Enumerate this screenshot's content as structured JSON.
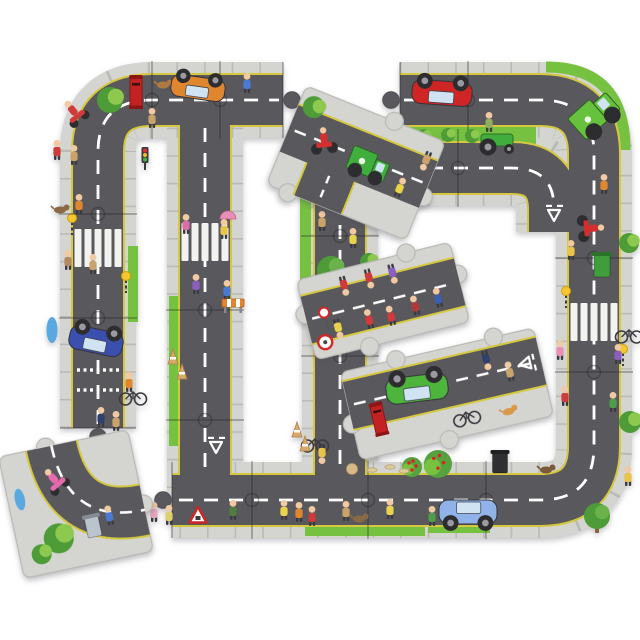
{
  "subject": "giant road jigsaw puzzle partially assembled on white background",
  "palette": {
    "background": "#ffffff",
    "sidewalk": "#d4d4d1",
    "sidewalkTick": "#b2b2ae",
    "pieceEdge": "#b9b9b5",
    "tarmac": "#59595d",
    "yellowLine": "#d5c83e",
    "centerLine": "#ffffff",
    "grass": "#76c13f",
    "bushDark": "#4d9c38",
    "bushLight": "#8cc94e",
    "skin": "#f1c9a2",
    "wheel": "#2d2d30",
    "joint": "rgba(35,35,40,0.38)"
  },
  "road_widths": {
    "sidewalk": 76,
    "yellow": 54,
    "tarmac": 50,
    "center": 2.8,
    "dash": "14 11",
    "tick": "1.6 26"
  },
  "assembled": {
    "roads": [
      {
        "name": "left-and-top-road",
        "d": "M 98 428 L 98 152 Q 98 100 152 100 L 283 100"
      },
      {
        "name": "topright-right-bottom-road",
        "d": "M 400 100 L 540 100 Q 594 100 594 154 L 594 446 Q 594 500 540 500 L 172 500"
      },
      {
        "name": "inner-road-a",
        "d": "M 205 100 L 205 492"
      },
      {
        "name": "inner-road-b",
        "d": "M 340 124 L 340 492"
      },
      {
        "name": "branch-road",
        "d": "M 400 168 L 512 168 Q 554 168 554 210 L 554 232"
      }
    ],
    "dashes": [
      "M 98 424 L 98 152 Q 98 100 152 100 L 279 100",
      "M 404 100 L 540 100 Q 594 100 594 154 L 594 446 Q 594 500 540 500 L 176 500",
      "M 205 128 L 205 470",
      "M 340 150 L 340 470",
      "M 404 168 L 512 168 Q 554 168 554 208"
    ],
    "grass_rects": [
      {
        "x": 402,
        "y": 126,
        "w": 134,
        "h": 19
      },
      {
        "x": 300,
        "y": 150,
        "w": 11,
        "h": 145
      },
      {
        "x": 169,
        "y": 296,
        "w": 11,
        "h": 150
      },
      {
        "x": 128,
        "y": 246,
        "w": 10,
        "h": 76
      },
      {
        "x": 305,
        "y": 527,
        "w": 120,
        "h": 9
      },
      {
        "x": 428,
        "y": 524,
        "w": 62,
        "h": 9
      }
    ],
    "grass_arcs": [
      {
        "d": "M 546 67 Q 625 67 625 150",
        "w": 11
      }
    ],
    "zebras": [
      {
        "x": 98,
        "y": 248
      },
      {
        "x": 205,
        "y": 242
      },
      {
        "x": 594,
        "y": 322
      }
    ],
    "beacons": [
      {
        "x": 72,
        "y": 220
      },
      {
        "x": 126,
        "y": 278
      },
      {
        "x": 566,
        "y": 293
      },
      {
        "x": 623,
        "y": 351
      }
    ],
    "dotted": [
      {
        "x": 98,
        "y": 370
      },
      {
        "x": 98,
        "y": 390
      }
    ],
    "giveways": [
      {
        "x": 340,
        "y": 176,
        "a": 0
      },
      {
        "x": 216,
        "y": 446,
        "a": 180
      },
      {
        "x": 554,
        "y": 214,
        "a": 180
      }
    ],
    "joints": [
      {
        "x": 152,
        "y": 100,
        "o": "v"
      },
      {
        "x": 220,
        "y": 100,
        "o": "v"
      },
      {
        "x": 468,
        "y": 100,
        "o": "v"
      },
      {
        "x": 98,
        "y": 214,
        "o": "h"
      },
      {
        "x": 98,
        "y": 318,
        "o": "h"
      },
      {
        "x": 594,
        "y": 258,
        "o": "h"
      },
      {
        "x": 594,
        "y": 372,
        "o": "h"
      },
      {
        "x": 252,
        "y": 500,
        "o": "v"
      },
      {
        "x": 368,
        "y": 500,
        "o": "v"
      },
      {
        "x": 486,
        "y": 500,
        "o": "v"
      },
      {
        "x": 205,
        "y": 310,
        "o": "h"
      },
      {
        "x": 205,
        "y": 420,
        "o": "h"
      },
      {
        "x": 340,
        "y": 236,
        "o": "h"
      },
      {
        "x": 340,
        "y": 356,
        "o": "h"
      },
      {
        "x": 458,
        "y": 168,
        "o": "v"
      }
    ],
    "tabs": [
      {
        "x": 283,
        "y": 100,
        "o": "v",
        "k": 1
      },
      {
        "x": 400,
        "y": 100,
        "o": "v",
        "k": -1
      },
      {
        "x": 400,
        "y": 168,
        "o": "v",
        "k": -1
      },
      {
        "x": 340,
        "y": 124,
        "o": "h",
        "k": -1
      },
      {
        "x": 98,
        "y": 428,
        "o": "h",
        "k": 1
      },
      {
        "x": 172,
        "y": 500,
        "o": "v",
        "k": -1
      }
    ],
    "decor": [
      {
        "t": "scooter",
        "n": "red-quad-rider",
        "x": 74,
        "y": 112,
        "r": -38,
        "c": "#cf3a3a"
      },
      {
        "t": "bush",
        "n": "bush",
        "x": 110,
        "y": 100,
        "s": 13
      },
      {
        "t": "postbox",
        "n": "red-postbox",
        "x": 136,
        "y": 93
      },
      {
        "t": "dog",
        "n": "brown-dog",
        "x": 163,
        "y": 85,
        "c": "#b07a3f"
      },
      {
        "t": "car",
        "n": "orange-car-overturned",
        "x": 198,
        "y": 88,
        "w": 54,
        "h": 22,
        "r": 188,
        "c": "#e0862f"
      },
      {
        "t": "person",
        "n": "pedestrian",
        "x": 247,
        "y": 85,
        "c": "#4a7bd4"
      },
      {
        "t": "person",
        "n": "pedestrian",
        "x": 152,
        "y": 120,
        "c": "#caa36b"
      },
      {
        "t": "person",
        "n": "child",
        "x": 57,
        "y": 152,
        "c": "#cf3a3a"
      },
      {
        "t": "person",
        "n": "child",
        "x": 74,
        "y": 157,
        "c": "#caa36b"
      },
      {
        "t": "trafficlight",
        "n": "traffic-light",
        "x": 145,
        "y": 157
      },
      {
        "t": "dog",
        "n": "dog",
        "x": 60,
        "y": 210,
        "c": "#8a6a45"
      },
      {
        "t": "person",
        "n": "pedestrian",
        "x": 79,
        "y": 206,
        "c": "#e0862f"
      },
      {
        "t": "person",
        "n": "pedestrian",
        "x": 68,
        "y": 262,
        "c": "#b58860"
      },
      {
        "t": "person",
        "n": "pedestrian",
        "x": 93,
        "y": 266,
        "c": "#caa36b"
      },
      {
        "t": "blob",
        "n": "blue-bollard",
        "x": 52,
        "y": 330,
        "w": 11,
        "h": 26,
        "c": "#5aa8e0"
      },
      {
        "t": "car",
        "n": "blue-car-tilted",
        "x": 96,
        "y": 341,
        "w": 54,
        "h": 24,
        "r": 192,
        "c": "#3a4fae"
      },
      {
        "t": "person",
        "n": "cyclist",
        "x": 129,
        "y": 384,
        "c": "#e0862f"
      },
      {
        "t": "bicycle",
        "n": "bicycle",
        "x": 133,
        "y": 396
      },
      {
        "t": "person",
        "n": "pedestrian",
        "x": 101,
        "y": 419,
        "c": "#2f3f6e"
      },
      {
        "t": "person",
        "n": "pedestrian",
        "x": 116,
        "y": 423,
        "c": "#caa36b"
      },
      {
        "t": "person",
        "n": "mother-with-pram",
        "x": 186,
        "y": 226,
        "c": "#d86fa8"
      },
      {
        "t": "umbrella",
        "n": "pink-umbrella",
        "x": 228,
        "y": 219,
        "c": "#e88fb8"
      },
      {
        "t": "person",
        "n": "pedestrian",
        "x": 224,
        "y": 231,
        "c": "#e8c44a"
      },
      {
        "t": "person",
        "n": "pedestrian",
        "x": 196,
        "y": 286,
        "c": "#8a5fc0"
      },
      {
        "t": "person",
        "n": "pedestrian",
        "x": 227,
        "y": 292,
        "c": "#4a7bd4"
      },
      {
        "t": "barrier",
        "n": "roadworks-barrier",
        "x": 233,
        "y": 303
      },
      {
        "t": "cone",
        "n": "cone",
        "x": 173,
        "y": 357
      },
      {
        "t": "cone",
        "n": "cone",
        "x": 182,
        "y": 372
      },
      {
        "t": "person",
        "n": "pedestrian",
        "x": 322,
        "y": 223,
        "c": "#caa36b"
      },
      {
        "t": "person",
        "n": "workman",
        "x": 353,
        "y": 240,
        "c": "#e8d44a"
      },
      {
        "t": "tree",
        "n": "tree",
        "x": 331,
        "y": 270,
        "s": 14
      },
      {
        "t": "bush",
        "n": "bush",
        "x": 369,
        "y": 262,
        "s": 9
      },
      {
        "t": "bush",
        "n": "bush",
        "x": 366,
        "y": 416,
        "s": 11
      },
      {
        "t": "bicycle",
        "n": "fallen-bicycle",
        "x": 315,
        "y": 443
      },
      {
        "t": "person",
        "n": "cyclist-upside-down",
        "x": 322,
        "y": 452,
        "r": 180,
        "c": "#e8c44a"
      },
      {
        "t": "cone",
        "n": "cone",
        "x": 297,
        "y": 430
      },
      {
        "t": "cone",
        "n": "cone",
        "x": 305,
        "y": 444
      },
      {
        "t": "bush",
        "n": "median-tree",
        "x": 424,
        "y": 136,
        "s": 7
      },
      {
        "t": "bush",
        "n": "median-tree",
        "x": 448,
        "y": 135,
        "s": 7
      },
      {
        "t": "bush",
        "n": "median-tree",
        "x": 472,
        "y": 136,
        "s": 7
      },
      {
        "t": "car",
        "n": "red-car-overturned",
        "x": 442,
        "y": 93,
        "w": 60,
        "h": 24,
        "r": 184,
        "c": "#cf2525"
      },
      {
        "t": "tractor",
        "n": "lawn-tractor",
        "x": 497,
        "y": 139,
        "c": "#3fae3d"
      },
      {
        "t": "person",
        "n": "tractor-driver",
        "x": 489,
        "y": 124,
        "c": "#8fae5f"
      },
      {
        "t": "truck",
        "n": "recycling-truck",
        "x": 594,
        "y": 114,
        "w": 46,
        "h": 28,
        "r": -42,
        "c": "#66c23c"
      },
      {
        "t": "person",
        "n": "pedestrian",
        "x": 604,
        "y": 186,
        "c": "#e0862f"
      },
      {
        "t": "motorbike",
        "n": "red-motorbike",
        "x": 590,
        "y": 228,
        "r": 85,
        "c": "#d32f2f"
      },
      {
        "t": "person",
        "n": "pedestrian",
        "x": 571,
        "y": 252,
        "c": "#e8c44a"
      },
      {
        "t": "bin",
        "n": "green-wheelie-bin",
        "x": 602,
        "y": 266,
        "w": 16,
        "h": 22,
        "c": "#3f9e3a"
      },
      {
        "t": "bush",
        "n": "bush",
        "x": 629,
        "y": 243,
        "s": 10
      },
      {
        "t": "bicycle",
        "n": "bicycle",
        "x": 629,
        "y": 334
      },
      {
        "t": "person",
        "n": "pedestrian",
        "x": 560,
        "y": 352,
        "c": "#e88fb8"
      },
      {
        "t": "person",
        "n": "pedestrian",
        "x": 618,
        "y": 356,
        "c": "#8a5fc0"
      },
      {
        "t": "person",
        "n": "pedestrian",
        "x": 565,
        "y": 398,
        "c": "#cf3a3a"
      },
      {
        "t": "person",
        "n": "pedestrian",
        "x": 613,
        "y": 404,
        "c": "#4f9e4a"
      },
      {
        "t": "bush",
        "n": "bush",
        "x": 630,
        "y": 422,
        "s": 11
      },
      {
        "t": "person",
        "n": "pedestrian",
        "x": 628,
        "y": 478,
        "c": "#e8c44a"
      },
      {
        "t": "tree",
        "n": "corner-tree",
        "x": 597,
        "y": 516,
        "s": 13
      },
      {
        "t": "car",
        "n": "blue-car",
        "x": 468,
        "y": 512,
        "w": 58,
        "h": 24,
        "c": "#8fb3e8"
      },
      {
        "t": "bin",
        "n": "black-bin",
        "x": 500,
        "y": 463,
        "w": 15,
        "h": 20,
        "c": "#2f2f33"
      },
      {
        "t": "appletree",
        "n": "apple-bush",
        "x": 438,
        "y": 464,
        "s": 14
      },
      {
        "t": "appletree",
        "n": "apple-bush",
        "x": 412,
        "y": 467,
        "s": 10
      },
      {
        "t": "dog",
        "n": "hedgehog",
        "x": 546,
        "y": 470,
        "c": "#7a5a38"
      },
      {
        "t": "bone",
        "n": "bone",
        "x": 372,
        "y": 470
      },
      {
        "t": "bone",
        "n": "bone",
        "x": 390,
        "y": 467
      },
      {
        "t": "bone",
        "n": "bone",
        "x": 404,
        "y": 471
      },
      {
        "t": "rock",
        "n": "rock",
        "x": 352,
        "y": 469
      },
      {
        "t": "person",
        "n": "old-lady",
        "x": 154,
        "y": 514,
        "c": "#e8a7c0"
      },
      {
        "t": "person",
        "n": "old-lady",
        "x": 169,
        "y": 517,
        "c": "#ded06e"
      },
      {
        "t": "signTriangle",
        "n": "roadworks-sign",
        "x": 198,
        "y": 516
      },
      {
        "t": "person",
        "n": "man-with-hose",
        "x": 233,
        "y": 512,
        "c": "#4f7f3f"
      },
      {
        "t": "person",
        "n": "workman",
        "x": 284,
        "y": 512,
        "c": "#e8d44a"
      },
      {
        "t": "person",
        "n": "workman",
        "x": 299,
        "y": 514,
        "c": "#e0862f"
      },
      {
        "t": "person",
        "n": "child",
        "x": 312,
        "y": 518,
        "c": "#cf3a3a"
      },
      {
        "t": "person",
        "n": "pedestrian",
        "x": 346,
        "y": 513,
        "c": "#caa36b"
      },
      {
        "t": "dog",
        "n": "dog",
        "x": 359,
        "y": 519,
        "c": "#8a6a45"
      },
      {
        "t": "person",
        "n": "workman",
        "x": 390,
        "y": 511,
        "c": "#e8d44a"
      },
      {
        "t": "person",
        "n": "man-feeding-birds",
        "x": 432,
        "y": 518,
        "c": "#4f9e4a"
      }
    ]
  },
  "loose_pieces": [
    {
      "name": "tee-junction-piece",
      "cx": 356,
      "cy": 163,
      "w": 150,
      "h": 106,
      "rot": 22,
      "type": "tee",
      "knobs": [
        {
          "s": "top",
          "o": 20
        },
        {
          "s": "right",
          "o": 6
        },
        {
          "s": "bottom",
          "o": -52
        }
      ],
      "decor": [
        {
          "t": "bush",
          "n": "bush",
          "x": -60,
          "y": -36,
          "s": 11
        },
        {
          "t": "motorbike",
          "n": "red-motorbike",
          "x": -38,
          "y": -8,
          "r": -28,
          "c": "#d32f2f"
        },
        {
          "t": "truck",
          "n": "green-lorry",
          "x": 12,
          "y": -4,
          "w": 40,
          "h": 24,
          "c": "#3fae3d"
        },
        {
          "t": "person",
          "n": "workman",
          "x": 50,
          "y": 8,
          "c": "#e8d44a"
        },
        {
          "t": "person",
          "n": "pedestrian-upside-down",
          "x": 64,
          "y": -30,
          "r": 180,
          "c": "#caa36b"
        }
      ]
    },
    {
      "name": "postbox-piece",
      "cx": 447,
      "cy": 394,
      "w": 198,
      "h": 90,
      "rot": -13,
      "type": "straight2",
      "knobs": [
        {
          "s": "top",
          "o": -42
        },
        {
          "s": "top",
          "o": 58
        },
        {
          "s": "bottom",
          "o": -8
        },
        {
          "s": "left",
          "o": 8
        }
      ],
      "decor": [
        {
          "t": "car",
          "n": "green-car-overturned",
          "x": -28,
          "y": -12,
          "w": 62,
          "h": 26,
          "r": 186,
          "c": "#4db43c"
        },
        {
          "t": "postbox",
          "n": "red-postbox",
          "x": -72,
          "y": 10
        },
        {
          "t": "bicycle",
          "n": "bicycle",
          "x": 14,
          "y": 26
        },
        {
          "t": "dog",
          "n": "corgi-dog",
          "x": 56,
          "y": 31,
          "c": "#d89a4a"
        },
        {
          "t": "person",
          "n": "policeman-upside-down",
          "x": 46,
          "y": -26,
          "r": 180,
          "c": "#2f3f6e"
        },
        {
          "t": "person",
          "n": "pedestrian",
          "x": 66,
          "y": -6,
          "c": "#caa36b"
        },
        {
          "t": "giveway",
          "n": "give-way-marking",
          "x": 84,
          "y": -12,
          "a": -90
        }
      ]
    },
    {
      "name": "crossing-patrol-piece",
      "cx": 383,
      "cy": 301,
      "w": 158,
      "h": 82,
      "rot": -14,
      "type": "straight",
      "knobs": [
        {
          "s": "left",
          "o": -6
        },
        {
          "s": "right",
          "o": -8
        },
        {
          "s": "top",
          "o": 34
        },
        {
          "s": "bottom",
          "o": -24
        }
      ],
      "decor": [
        {
          "t": "person",
          "n": "child-upside-down",
          "x": -34,
          "y": -26,
          "r": 180,
          "c": "#cf3a3a"
        },
        {
          "t": "person",
          "n": "child-upside-down",
          "x": -8,
          "y": -27,
          "r": 180,
          "c": "#cf3a3a"
        },
        {
          "t": "person",
          "n": "child-upside-down",
          "x": 16,
          "y": -26,
          "r": 180,
          "c": "#8a5fc0"
        },
        {
          "t": "person",
          "n": "crossing-patrol-upside-down",
          "x": -50,
          "y": 14,
          "r": 180,
          "c": "#e8d44a"
        },
        {
          "t": "lollipop",
          "n": "lollipop-sign",
          "x": -60,
          "y": 6
        },
        {
          "t": "person",
          "n": "child",
          "x": -18,
          "y": 16,
          "c": "#cf3a3a"
        },
        {
          "t": "person",
          "n": "child",
          "x": 4,
          "y": 18,
          "c": "#cf3a3a"
        },
        {
          "t": "person",
          "n": "lady-in-red",
          "x": 30,
          "y": 14,
          "c": "#b03a3a"
        },
        {
          "t": "person",
          "n": "mechanic",
          "x": 54,
          "y": 12,
          "c": "#3a5fae"
        },
        {
          "t": "signCircle",
          "n": "round-sign",
          "x": -66,
          "y": 26
        }
      ]
    },
    {
      "name": "detached-corner-piece",
      "cx": 76,
      "cy": 504,
      "w": 132,
      "h": 124,
      "rot": -12,
      "type": "corner",
      "corner_d": "M -12 -62 Q -12 20 66 20",
      "knobs": [
        {
          "s": "top",
          "o": -18
        },
        {
          "s": "right",
          "o": 14
        }
      ],
      "decor": [
        {
          "t": "scooter",
          "n": "pink-scooter-rider",
          "x": -16,
          "y": -28,
          "r": -28,
          "c": "#e868b0"
        },
        {
          "t": "bush",
          "n": "bush",
          "x": -24,
          "y": 30,
          "s": 15
        },
        {
          "t": "bush",
          "n": "bush",
          "x": -44,
          "y": 42,
          "s": 10
        },
        {
          "t": "person",
          "n": "man-with-litter-bin",
          "x": 30,
          "y": 20,
          "c": "#4a7bd4"
        },
        {
          "t": "bin",
          "n": "litter-basket",
          "x": 12,
          "y": 26,
          "w": 14,
          "h": 20,
          "c": "#b9c4cc"
        },
        {
          "t": "blob",
          "n": "blue-sign",
          "x": -54,
          "y": -16,
          "w": 10,
          "h": 22,
          "c": "#5aa8e0"
        }
      ]
    }
  ]
}
